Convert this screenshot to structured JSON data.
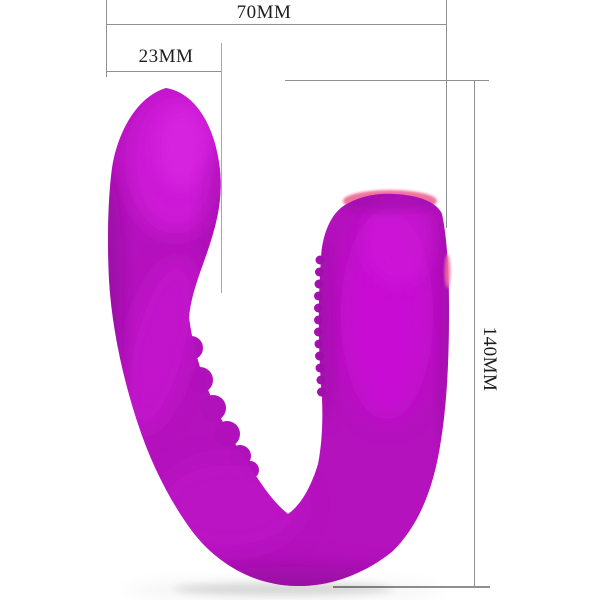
{
  "scene": {
    "background": "#ffffff",
    "description": "Product dimension diagram of a U-shaped purple silicone massager"
  },
  "product": {
    "name": "U-shaped silicone massager",
    "primary_color": "#b412bd",
    "highlight_color": "#d21ddb",
    "shade_color": "#85098f",
    "tip_accent_color": "#f0739e",
    "texture_bump_color": "#b011ba",
    "texture_ridge_color": "#a50fb0"
  },
  "dimensions": {
    "line_color": "#8f8f8f",
    "label_color": "#1e1e1e",
    "overall_width": {
      "label": "70MM"
    },
    "head_width": {
      "label": "23MM"
    },
    "overall_height": {
      "label": "140MM"
    }
  }
}
